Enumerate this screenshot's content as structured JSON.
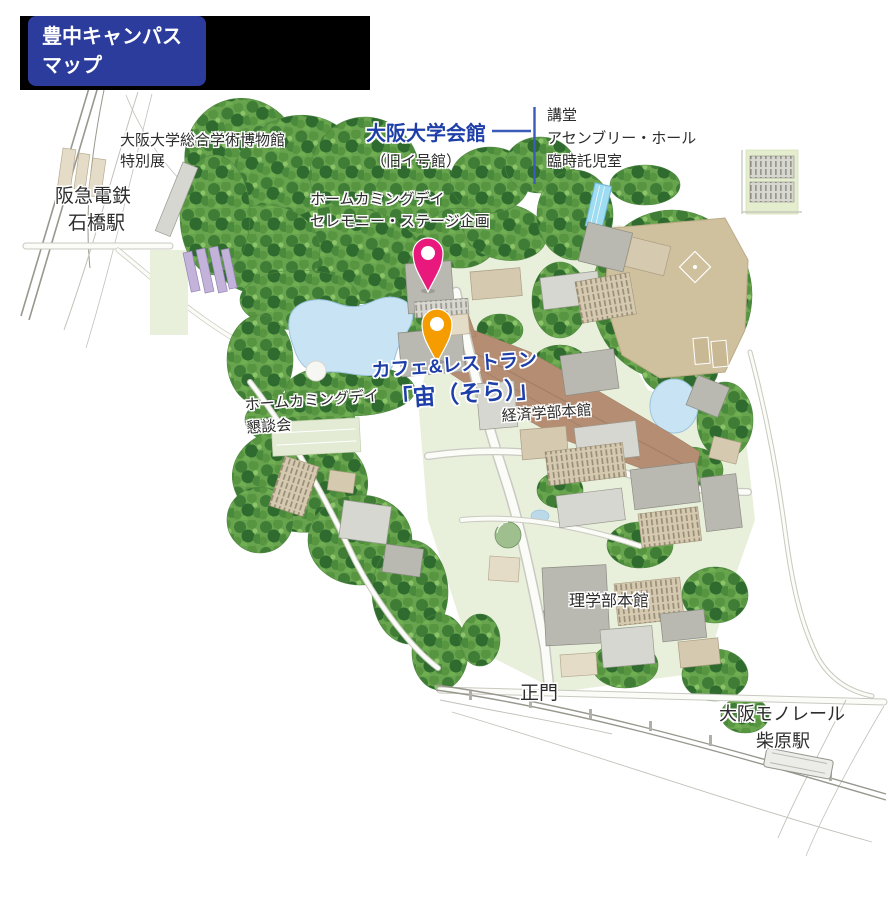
{
  "banner": {
    "line1": "豊中キャンパス",
    "line2": "マップ"
  },
  "map_labels": {
    "museum": {
      "line1": "大阪大学総合学術博物館",
      "line2": "特別展"
    },
    "hankyu_station": {
      "line1": "阪急電鉄",
      "line2": "石橋駅"
    },
    "university_hall": {
      "title": "大阪大学会館",
      "subtitle": "（旧イ号館）",
      "note_line1": "講堂",
      "note_line2": "アセンブリー・ホール",
      "note_line3": "臨時託児室"
    },
    "homecoming_ceremony": {
      "line1": "ホームカミングデイ",
      "line2": "セレモニー・ステージ企画"
    },
    "cafe": {
      "line1": "カフェ&レストラン",
      "line2": "「宙（そら）」"
    },
    "homecoming_meeting": {
      "line1": "ホームカミングデイ",
      "line2": "懇談会"
    },
    "economics_main": "経済学部本館",
    "science_main": "理学部本館",
    "main_gate": "正門",
    "monorail": {
      "line1": "大阪モノレール",
      "line2": "柴原駅"
    }
  },
  "pins": [
    {
      "id": "ceremony-venue-pin",
      "color": "#e8187d"
    },
    {
      "id": "cafe-venue-pin",
      "color": "#f59c00"
    }
  ],
  "colors": {
    "banner_bg": "#2c3c9c",
    "banner_strip": "#000000",
    "venue_label_blue": "#1f3fa8",
    "connector_blue": "#3a5cb8",
    "pin_pink": "#e8187d",
    "pin_orange": "#f59c00",
    "pond_blue": "#c7e3f4",
    "field_tan": "#cfc09e",
    "plaza_brown": "#b48d73"
  }
}
